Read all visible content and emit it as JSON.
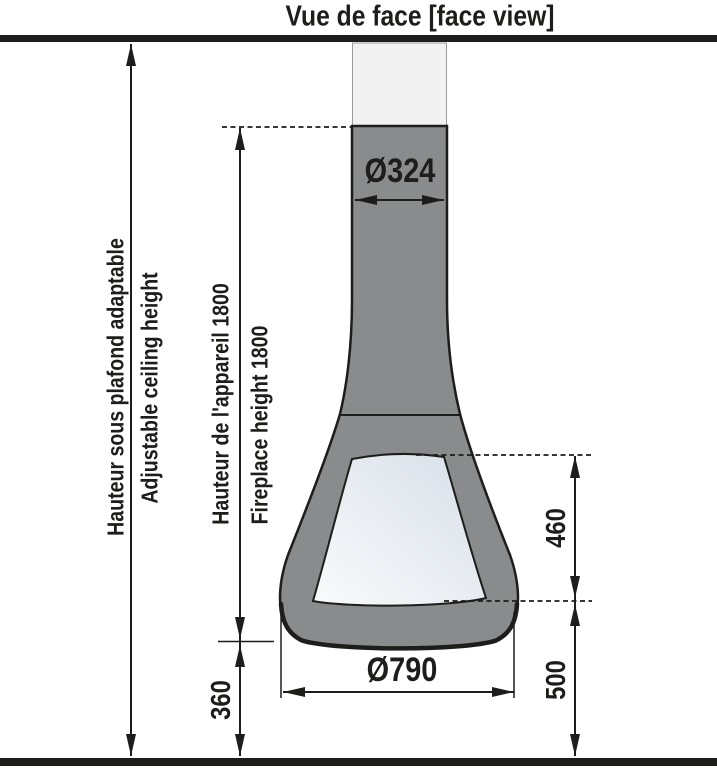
{
  "title": "Vue de face [face view]",
  "labels": {
    "ceiling_height_fr": "Hauteur sous plafond adaptable",
    "ceiling_height_en": "Adjustable ceiling height",
    "appliance_height_fr": "Hauteur de l'appareil 1800",
    "appliance_height_en": "Fireplace height 1800"
  },
  "dimensions": {
    "flue_diameter": "Ø324",
    "base_diameter": "Ø790",
    "firebox_opening_height": "460",
    "base_to_floor": "500",
    "bottom_clearance": "360"
  },
  "colors": {
    "ink": "#1d1d1b",
    "body_gray": "#8a8b8d",
    "flue_light": "#f1f1f2",
    "flue_border": "#9b9b9d",
    "opening_dark": "#d8dfe8",
    "opening_light": "#f9fbfc",
    "background": "#ffffff"
  }
}
